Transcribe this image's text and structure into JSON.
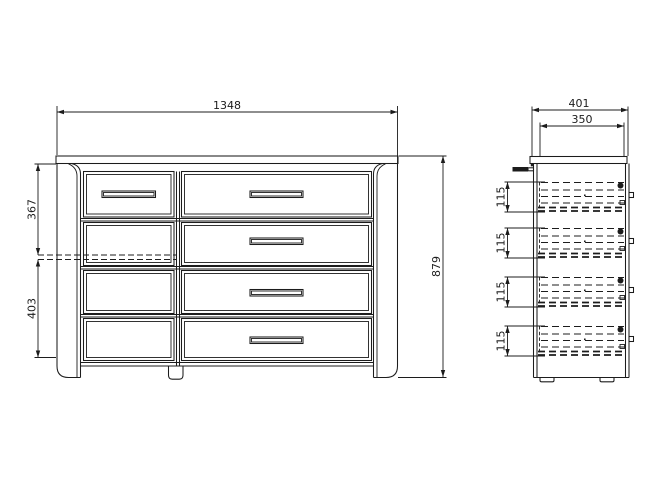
{
  "canvas": {
    "background": "#ffffff",
    "line_color": "#1c1c1c"
  },
  "drawing_type": "furniture technical drawing - chest of drawers, front and side views",
  "front_view": {
    "width": "1348",
    "height": "879",
    "upper_height": "367",
    "lower_height": "403",
    "drawer_rows": 4,
    "drawer_columns": 2
  },
  "side_view": {
    "depth": "401",
    "drawer_depth": "350",
    "drawer_heights": [
      "115",
      "115",
      "115",
      "115"
    ]
  }
}
